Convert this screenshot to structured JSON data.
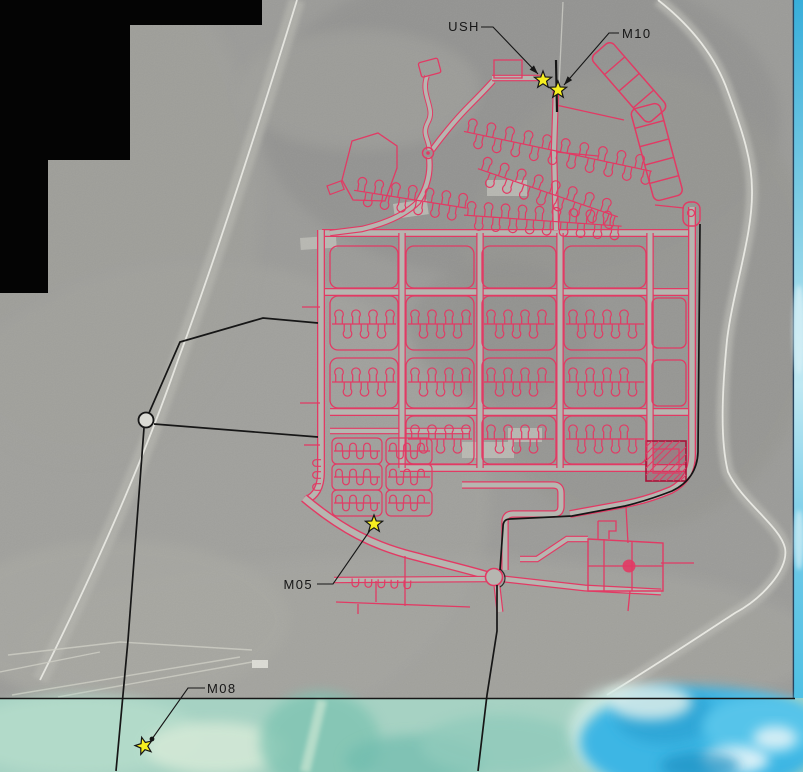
{
  "map": {
    "description": "annotated-aerial-site-plan",
    "markers": [
      {
        "id": "USH",
        "label": "USH",
        "x": 543,
        "y": 80,
        "leader": [
          [
            481,
            27
          ],
          [
            493,
            27
          ],
          [
            538,
            74
          ]
        ],
        "arrow": true,
        "dot": false,
        "rot": 0
      },
      {
        "id": "M10",
        "label": "M10",
        "x": 558,
        "y": 90,
        "leader": [
          [
            619,
            33
          ],
          [
            609,
            33
          ],
          [
            564,
            85
          ]
        ],
        "arrow": true,
        "dot": false,
        "rot": 0
      },
      {
        "id": "M05",
        "label": "M05",
        "x": 374,
        "y": 524,
        "leader": [
          [
            317,
            584
          ],
          [
            333,
            584
          ],
          [
            371,
            529
          ]
        ],
        "arrow": false,
        "dot": false,
        "rot": 0
      },
      {
        "id": "M08",
        "label": "M08",
        "x": 144,
        "y": 746,
        "leader": [
          [
            205,
            688
          ],
          [
            188,
            688
          ],
          [
            152,
            739
          ]
        ],
        "arrow": false,
        "dot": true,
        "rot": -15
      }
    ],
    "colors": {
      "road_network": "#e23a64",
      "road_network_dark": "#a81238",
      "road_fill": "#b6b6b0",
      "survey_line": "#161616",
      "marker_fill": "#f6ee20",
      "marker_outline": "#151515",
      "label_text": "#161616",
      "mask": "#040404",
      "photo_gray": "#9b9b98",
      "lagoon_teal": "#a6d2c3",
      "ocean_blue": "#3cb6e4",
      "shoreline_white": "#ecece6"
    }
  }
}
